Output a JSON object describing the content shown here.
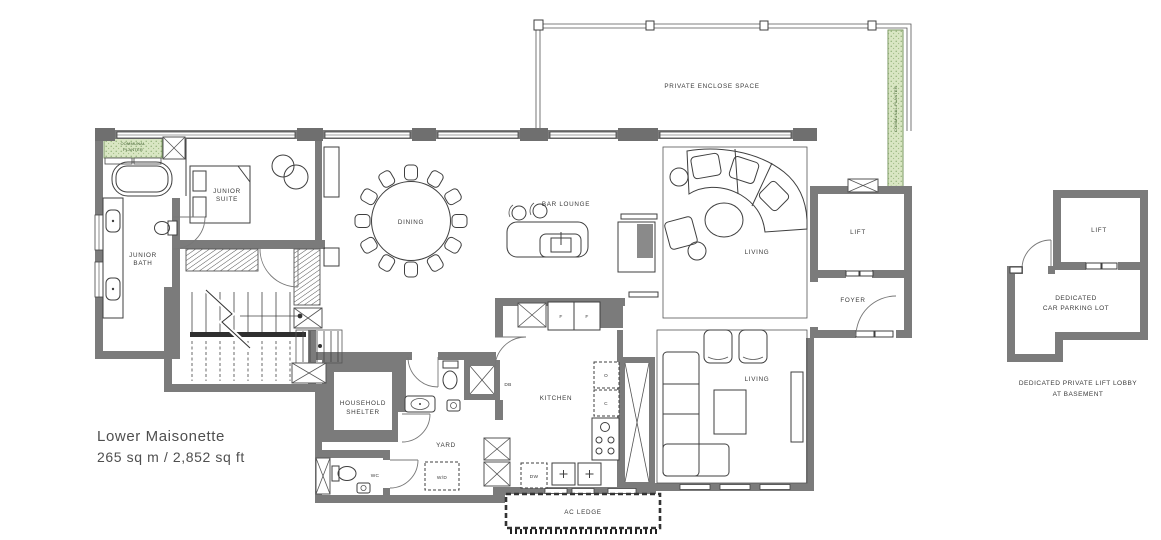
{
  "plan": {
    "title": "Lower Maisonette",
    "area": "265 sq m / 2,852 sq ft"
  },
  "rooms": {
    "private_enclose_space": "PRIVATE ENCLOSE SPACE",
    "junior_suite": [
      "JUNIOR",
      "SUITE"
    ],
    "junior_bath": [
      "JUNIOR",
      "BATH"
    ],
    "dining": "DINING",
    "bar_lounge": "BAR LOUNGE",
    "living_upper": "LIVING",
    "living_lower": "LIVING",
    "lift": "LIFT",
    "foyer": "FOYER",
    "kitchen": "KITCHEN",
    "household_shelter": [
      "HOUSEHOLD",
      "SHELTER"
    ],
    "yard": "YARD",
    "wc": "WC",
    "ac_ledge": "AC LEDGE"
  },
  "fixtures": {
    "washer_dryer": "W/D",
    "dishwasher": "DW",
    "db": "DB",
    "fridge1": "F",
    "fridge2": "F",
    "oven": "O",
    "cabinet_c": "C"
  },
  "planters": {
    "top_left": [
      "COMMUNAL",
      "PLANTER"
    ],
    "right_strip": "COMMUNAL PLANTER"
  },
  "basement": {
    "lift": "LIFT",
    "parking": [
      "DEDICATED",
      "CAR PARKING LOT"
    ],
    "caption": [
      "DEDICATED PRIVATE LIFT LOBBY",
      "AT BASEMENT"
    ]
  },
  "colors": {
    "wall": "#7b7b7b",
    "line": "#3f3f3f",
    "planter_fill": "#d9e6c3",
    "planter_dot": "#7da163",
    "text": "#3a3a3a",
    "background": "#ffffff"
  }
}
